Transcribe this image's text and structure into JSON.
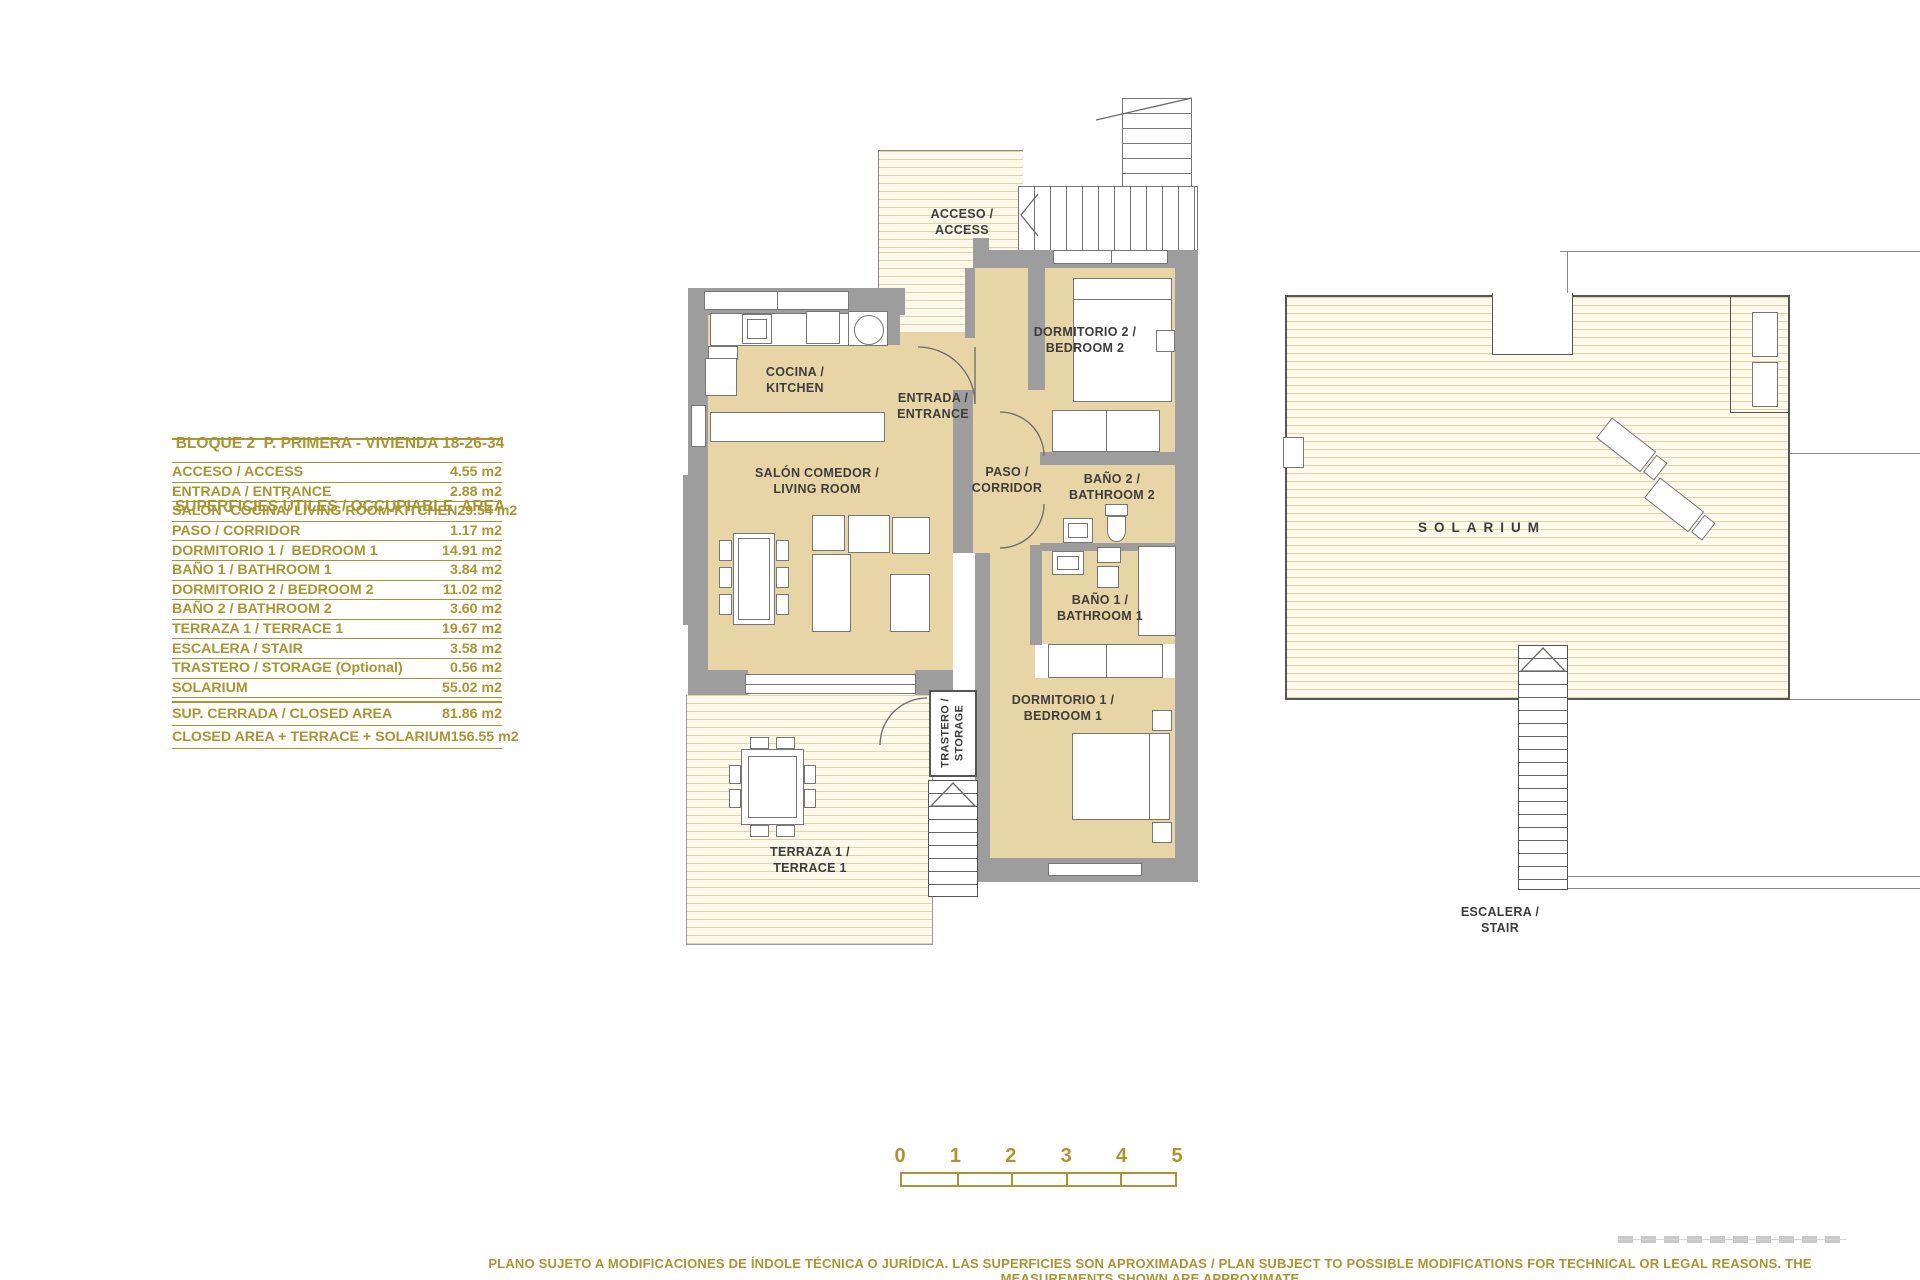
{
  "info_panel": {
    "title_line1": "BLOQUE 2  P. PRIMERA - VIVIENDA 18-26-34",
    "title_line2": "SUPERFICIES ÚTILES / OCCUPIABLE  AREA",
    "rows": [
      {
        "label": "ACCESO / ACCESS",
        "value": "4.55 m2"
      },
      {
        "label": "ENTRADA / ENTRANCE",
        "value": "2.88 m2"
      },
      {
        "label": "SALON -COCINA/ LIVING ROOM-KITCHEN",
        "value": "29.54 m2"
      },
      {
        "label": "PASO / CORRIDOR",
        "value": "1.17 m2"
      },
      {
        "label": "DORMITORIO 1 /  BEDROOM 1",
        "value": "14.91 m2"
      },
      {
        "label": "BAÑO 1 / BATHROOM 1",
        "value": "3.84 m2"
      },
      {
        "label": "DORMITORIO 2 / BEDROOM 2",
        "value": "11.02 m2"
      },
      {
        "label": "BAÑO 2 / BATHROOM 2",
        "value": "3.60 m2"
      },
      {
        "label": "TERRAZA 1 / TERRACE 1",
        "value": "19.67 m2"
      },
      {
        "label": "ESCALERA / STAIR",
        "value": "3.58 m2"
      },
      {
        "label": "TRASTERO / STORAGE (Optional)",
        "value": "0.56 m2"
      },
      {
        "label": "SOLARIUM",
        "value": "55.02 m2"
      }
    ],
    "summary_rows": [
      {
        "label": "SUP. CERRADA / CLOSED AREA",
        "value": "81.86 m2"
      },
      {
        "label": "CLOSED AREA + TERRACE + SOLARIUM",
        "value": "156.55 m2"
      }
    ]
  },
  "plan": {
    "labels": {
      "acceso": {
        "line1": "ACCESO /",
        "line2": "ACCESS"
      },
      "cocina": {
        "line1": "COCINA /",
        "line2": "KITCHEN"
      },
      "entrada": {
        "line1": "ENTRADA /",
        "line2": "ENTRANCE"
      },
      "salon": {
        "line1": "SALÓN COMEDOR /",
        "line2": "LIVING ROOM"
      },
      "paso": {
        "line1": "PASO /",
        "line2": "CORRIDOR"
      },
      "dormitorio2": {
        "line1": "DORMITORIO 2 /",
        "line2": "BEDROOM 2"
      },
      "bano2": {
        "line1": "BAÑO 2 /",
        "line2": "BATHROOM 2"
      },
      "bano1": {
        "line1": "BAÑO 1 /",
        "line2": "BATHROOM 1"
      },
      "dormitorio1": {
        "line1": "DORMITORIO 1 /",
        "line2": "BEDROOM 1"
      },
      "trastero": {
        "line1": "TRASTERO /",
        "line2": "STORAGE"
      },
      "terraza": {
        "line1": "TERRAZA 1 /",
        "line2": "TERRACE 1"
      },
      "solarium": "SOLARIUM",
      "escalera": {
        "line1": "ESCALERA /",
        "line2": "STAIR"
      }
    }
  },
  "scale_bar": {
    "ticks": [
      "0",
      "1",
      "2",
      "3",
      "4",
      "5"
    ]
  },
  "footer": {
    "disclaimer": "PLANO SUJETO A MODIFICACIONES DE ÍNDOLE TÉCNICA O JURÍDICA. LAS SUPERFICIES SON APROXIMADAS / PLAN SUBJECT TO POSSIBLE MODIFICATIONS FOR TECHNICAL OR LEGAL REASONS. THE MEASUREMENTS SHOWN ARE APPROXIMATE"
  },
  "colors": {
    "gold": "#AB9530",
    "wall_gray": "#9D9D9D",
    "floor_tan": "#E8D5A5",
    "hatch_line": "#DCD5A8",
    "label_gray": "#3D3D3D"
  }
}
